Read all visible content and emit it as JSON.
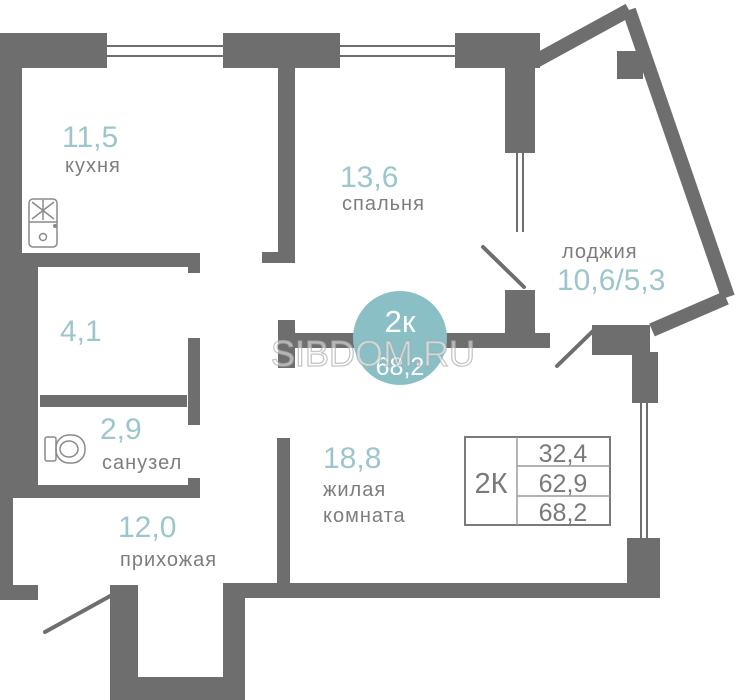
{
  "watermark": "SIBDOM.RU",
  "badge": {
    "type": "2к",
    "area": "68,2"
  },
  "rooms": {
    "kitchen": {
      "area": "11,5",
      "name": "кухня"
    },
    "bedroom": {
      "area": "13,6",
      "name": "спальня"
    },
    "loggia": {
      "area": "10,6/5,3",
      "name": "лоджия"
    },
    "bathroom": {
      "area": "4,1"
    },
    "wc": {
      "area": "2,9",
      "name": "санузел"
    },
    "hallway": {
      "area": "12,0",
      "name": "прихожая"
    },
    "living_room": {
      "area": "18,8",
      "name_line1": "жилая",
      "name_line2": "комната"
    }
  },
  "summary_table": {
    "type": "2К",
    "rows": [
      "32,4",
      "62,9",
      "68,2"
    ]
  },
  "colors": {
    "wall": "#6e6e6e",
    "accent_badge": "#8abfc6",
    "area_number": "#9cc6cc",
    "room_label": "#7d7d7d",
    "table_text": "#7a7a7a"
  }
}
